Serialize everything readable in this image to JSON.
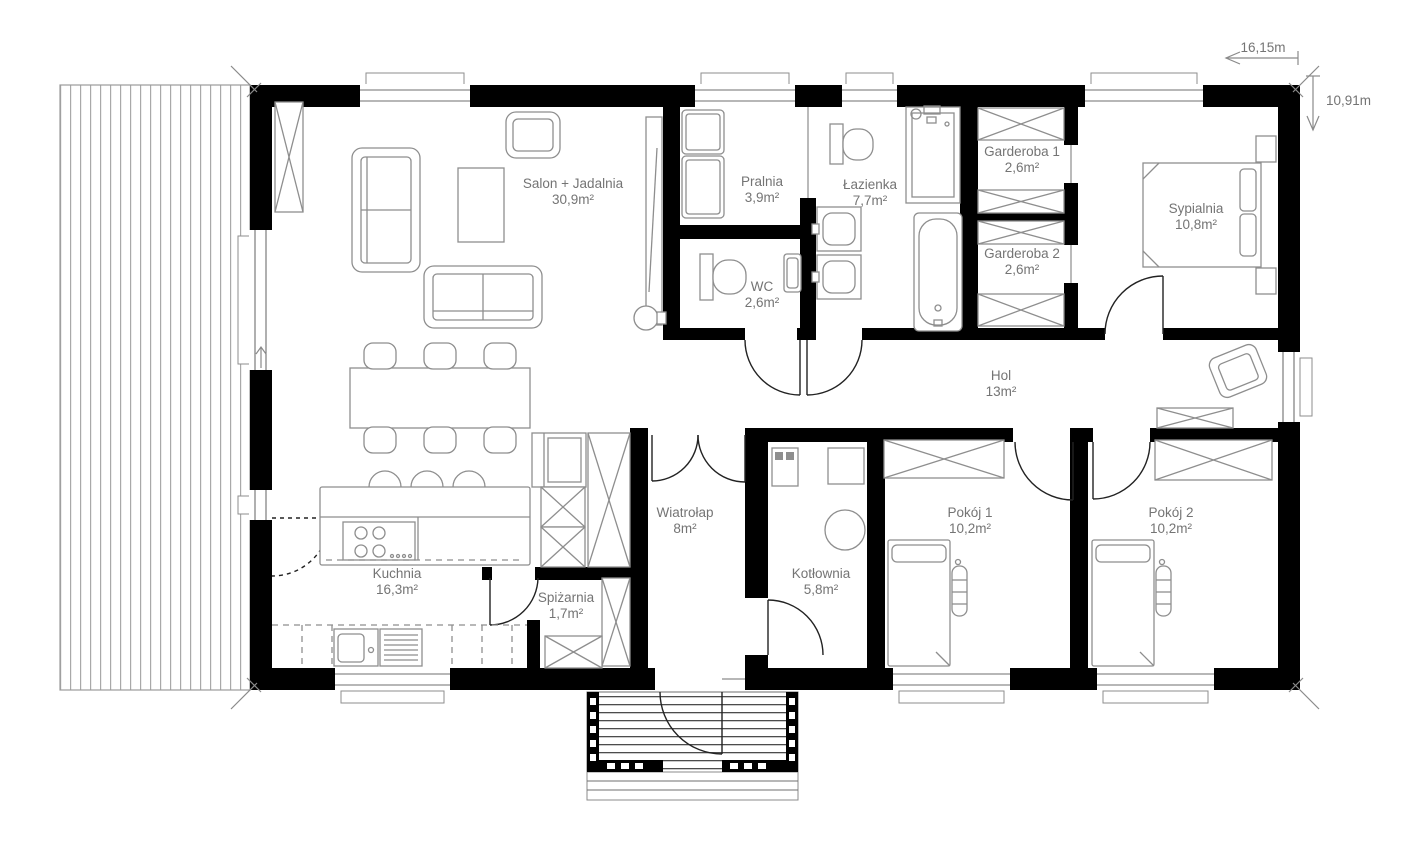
{
  "dimensions": {
    "width_label": "16,15m",
    "height_label": "10,91m"
  },
  "rooms": [
    {
      "name": "Salon + Jadalnia",
      "area": "30,9m²"
    },
    {
      "name": "Pralnia",
      "area": "3,9m²"
    },
    {
      "name": "WC",
      "area": "2,6m²"
    },
    {
      "name": "Łazienka",
      "area": "7,7m²"
    },
    {
      "name": "Garderoba 1",
      "area": "2,6m²"
    },
    {
      "name": "Garderoba 2",
      "area": "2,6m²"
    },
    {
      "name": "Sypialnia",
      "area": "10,8m²"
    },
    {
      "name": "Hol",
      "area": "13m²"
    },
    {
      "name": "Wiatrołap",
      "area": "8m²"
    },
    {
      "name": "Spiżarnia",
      "area": "1,7m²"
    },
    {
      "name": "Kuchnia",
      "area": "16,3m²"
    },
    {
      "name": "Kotłownia",
      "area": "5,8m²"
    },
    {
      "name": "Pokój 1",
      "area": "10,2m²"
    },
    {
      "name": "Pokój 2",
      "area": "10,2m²"
    }
  ]
}
